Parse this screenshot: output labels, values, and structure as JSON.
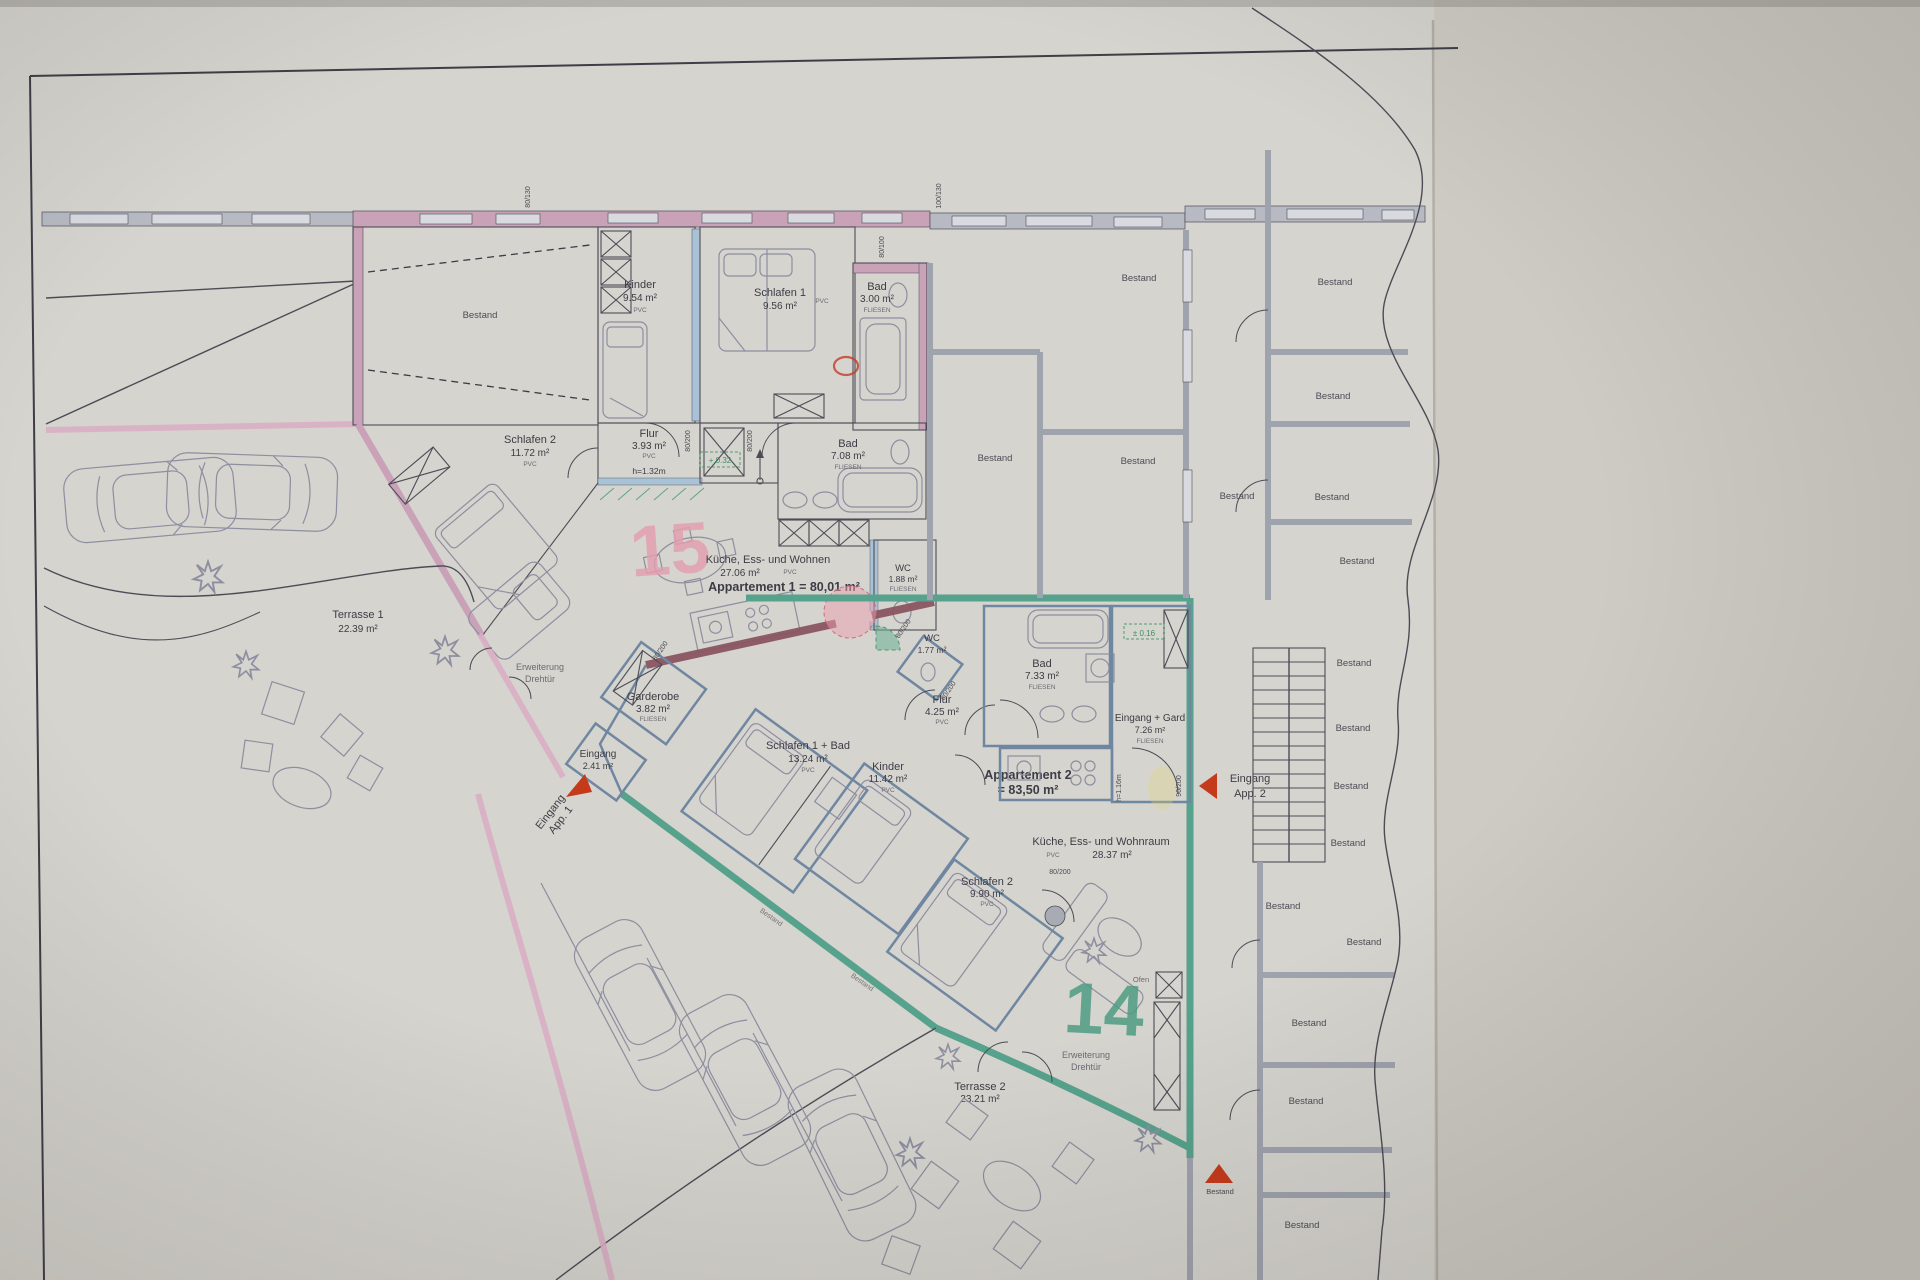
{
  "bestand": "Bestand",
  "colors": {
    "paper": "#d6d4ce",
    "apartment1_pink": "#c9a2b8",
    "apartment2_teal": "#57a28c",
    "shared_wall_maroon": "#8a5560",
    "interior_wall_blue": "#6f87a0",
    "marker15_pink": "#e39fb0",
    "marker14_green": "#4e9c82",
    "arrow_red": "#c63a1c",
    "level_green": "#4e9d6f"
  },
  "apartment1": {
    "marker": "15",
    "title": "Appartement 1 = 80,01 m²",
    "rooms": {
      "kinder": {
        "name": "Kinder",
        "area": "9.54 m²",
        "floor": "PVC"
      },
      "schlafen1": {
        "name": "Schlafen 1",
        "area": "9.56 m²",
        "floor": "PVC"
      },
      "bad_klein": {
        "name": "Bad",
        "area": "3.00 m²",
        "floor": "FLIESEN"
      },
      "schlafen2": {
        "name": "Schlafen 2",
        "area": "11.72 m²",
        "floor": "PVC"
      },
      "flur": {
        "name": "Flur",
        "area": "3.93 m²",
        "floor": "PVC",
        "height_note": "h=1.32m"
      },
      "bad": {
        "name": "Bad",
        "area": "7.08 m²",
        "floor": "FLIESEN"
      },
      "wohnen": {
        "name": "Küche, Ess- und Wohnen",
        "area": "27.06 m²",
        "floor": "PVC"
      },
      "wc": {
        "name": "WC",
        "area": "1.88 m²",
        "floor": "FLIESEN"
      },
      "terrasse": {
        "name": "Terrasse 1",
        "area": "22.39 m²"
      }
    },
    "erweiterung": {
      "line1": "Erweiterung",
      "line2": "Drehtür"
    },
    "eingang": {
      "line1": "Eingang",
      "line2": "App. 1"
    }
  },
  "apartment2": {
    "marker": "14",
    "title_line1": "Appartement 2",
    "title_line2": "= 83,50 m²",
    "rooms": {
      "garderobe": {
        "name": "Garderobe",
        "area": "3.82 m²",
        "floor": "FLIESEN"
      },
      "eingang": {
        "name": "Eingang",
        "area": "2.41 m²"
      },
      "schlafen1": {
        "name": "Schlafen 1 + Bad",
        "area": "13.24 m²",
        "floor": "PVC"
      },
      "kinder": {
        "name": "Kinder",
        "area": "11.42 m²",
        "floor": "PVC"
      },
      "wc": {
        "name": "WC",
        "area": "1.77 m²"
      },
      "bad": {
        "name": "Bad",
        "area": "7.33 m²",
        "floor": "FLIESEN"
      },
      "flur": {
        "name": "Flur",
        "area": "4.25 m²",
        "floor": "PVC"
      },
      "eingang_gard": {
        "name": "Eingang + Gard",
        "area": "7.26 m²",
        "floor": "FLIESEN",
        "height_note": "h=1.16m"
      },
      "wohnraum": {
        "name": "Küche, Ess- und Wohnraum",
        "area": "28.37 m²",
        "floor": "PVC"
      },
      "schlafen2": {
        "name": "Schlafen 2",
        "area": "9.90 m²",
        "floor": "PVC"
      },
      "terrasse": {
        "name": "Terrasse 2",
        "area": "23.21 m²"
      },
      "ofen": "Ofen"
    },
    "erweiterung": {
      "line1": "Erweiterung",
      "line2": "Drehtür"
    },
    "eingang_label": {
      "line1": "Eingang",
      "line2": "App. 2"
    }
  },
  "levels": {
    "kitchen": "+ 0.32",
    "entry": "± 0.16"
  },
  "dims": {
    "d80_130": "80/130",
    "d100_130": "100/130",
    "d80_100": "80/100",
    "d80_200": "80/200",
    "d90_200": "90/200"
  }
}
